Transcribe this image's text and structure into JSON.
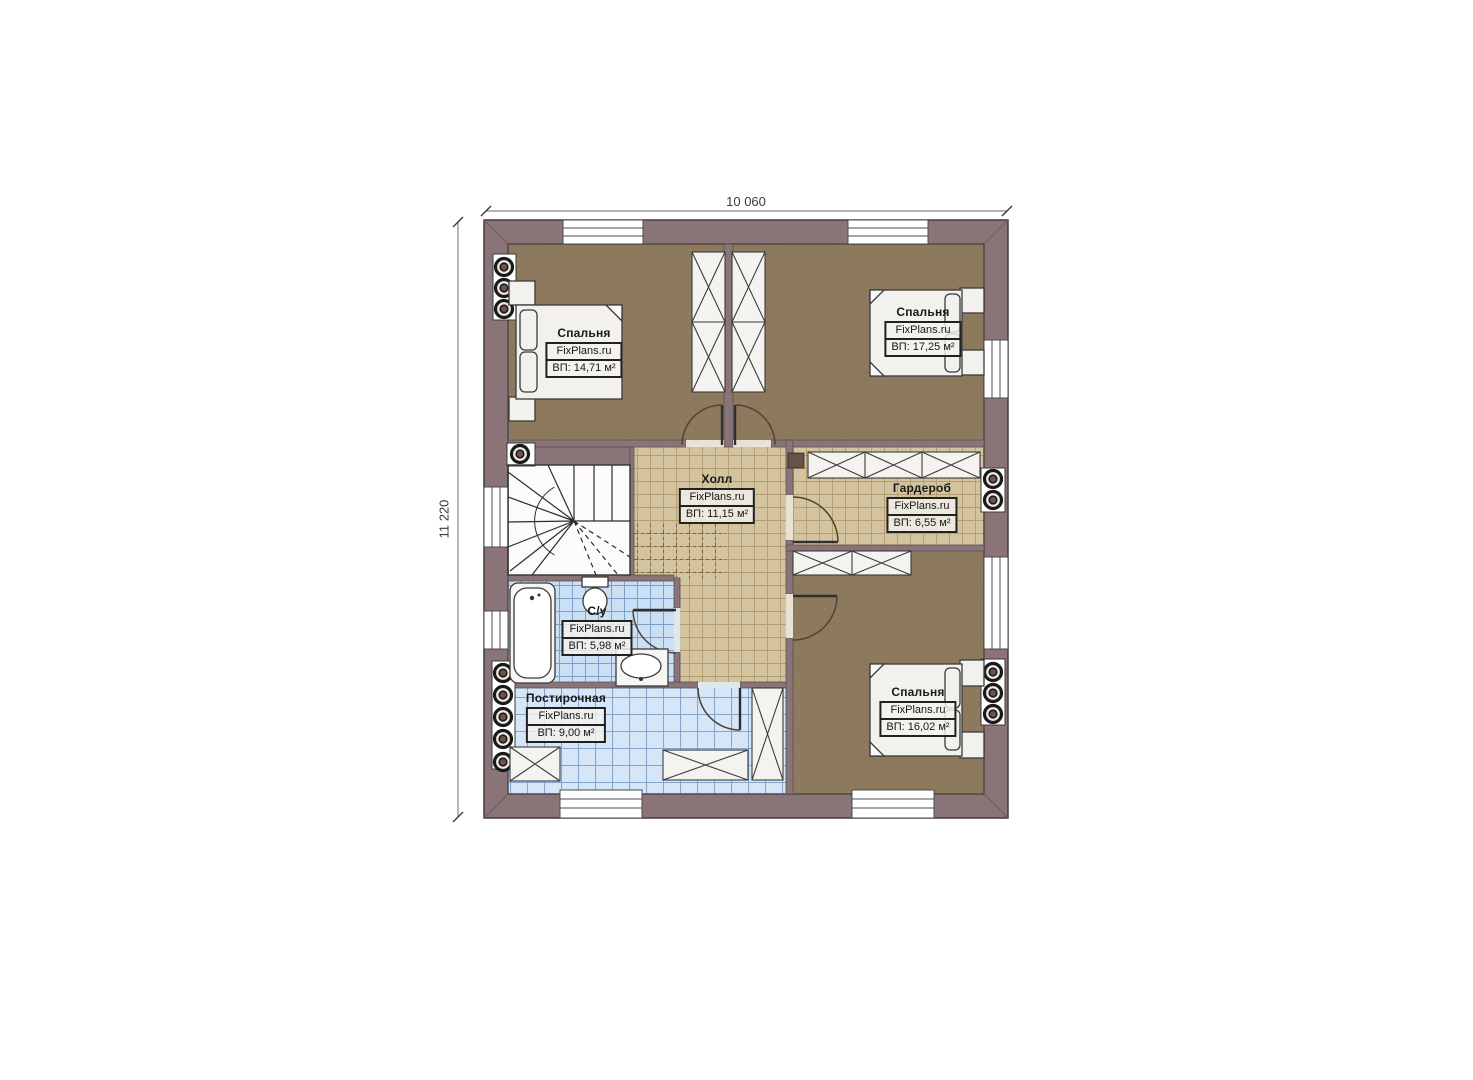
{
  "plan": {
    "dimensions": {
      "width_label": "10 060",
      "height_label": "11 220"
    },
    "rooms": [
      {
        "key": "bedroom-top-left",
        "name": "Спальня",
        "brand": "FixPlans.ru",
        "area": "ВП: 14,71 м²"
      },
      {
        "key": "bedroom-top-right",
        "name": "Спальня",
        "brand": "FixPlans.ru",
        "area": "ВП: 17,25 м²"
      },
      {
        "key": "hall",
        "name": "Холл",
        "brand": "FixPlans.ru",
        "area": "ВП: 11,15 м²"
      },
      {
        "key": "wardrobe",
        "name": "Гардероб",
        "brand": "FixPlans.ru",
        "area": "ВП: 6,55 м²"
      },
      {
        "key": "bathroom",
        "name": "С/у",
        "brand": "FixPlans.ru",
        "area": "ВП: 5,98 м²"
      },
      {
        "key": "laundry",
        "name": "Постирочная",
        "brand": "FixPlans.ru",
        "area": "ВП: 9,00 м²"
      },
      {
        "key": "bedroom-bottom-right",
        "name": "Спальня",
        "brand": "FixPlans.ru",
        "area": "ВП: 16,02 м²"
      }
    ],
    "colors": {
      "wall": "#8a7478",
      "bedroom_floor": "#8d7a5e",
      "hall_tile": "#d3c39e",
      "bath_tile": "#cce0f5",
      "laundry_tile": "#d4e6f8",
      "outline": "#3a3a3a",
      "background": "#ffffff"
    }
  }
}
